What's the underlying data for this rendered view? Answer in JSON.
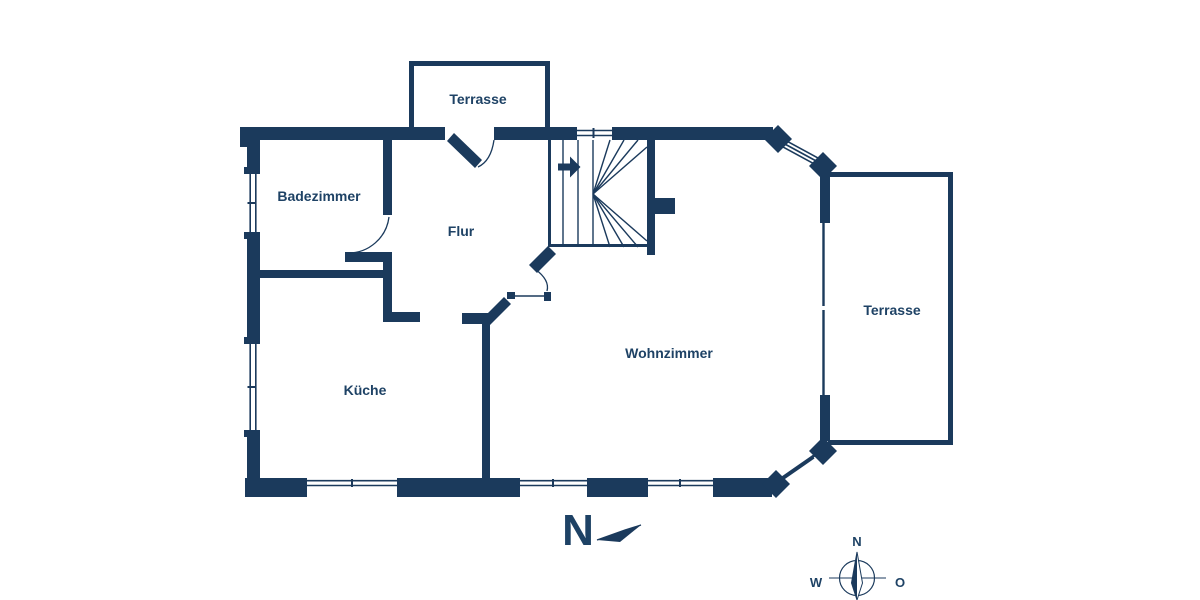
{
  "floor_plan": {
    "rooms": {
      "badezimmer": "Badezimmer",
      "flur": "Flur",
      "kueche": "Küche",
      "wohnzimmer": "Wohnzimmer",
      "terrasse_top": "Terrasse",
      "terrasse_right": "Terrasse"
    },
    "north_indicator": "N",
    "compass": {
      "north": "N",
      "west": "W",
      "east": "O"
    },
    "colors": {
      "wall": "#1b3a5c",
      "label": "#1e4265",
      "background": "#ffffff"
    }
  }
}
